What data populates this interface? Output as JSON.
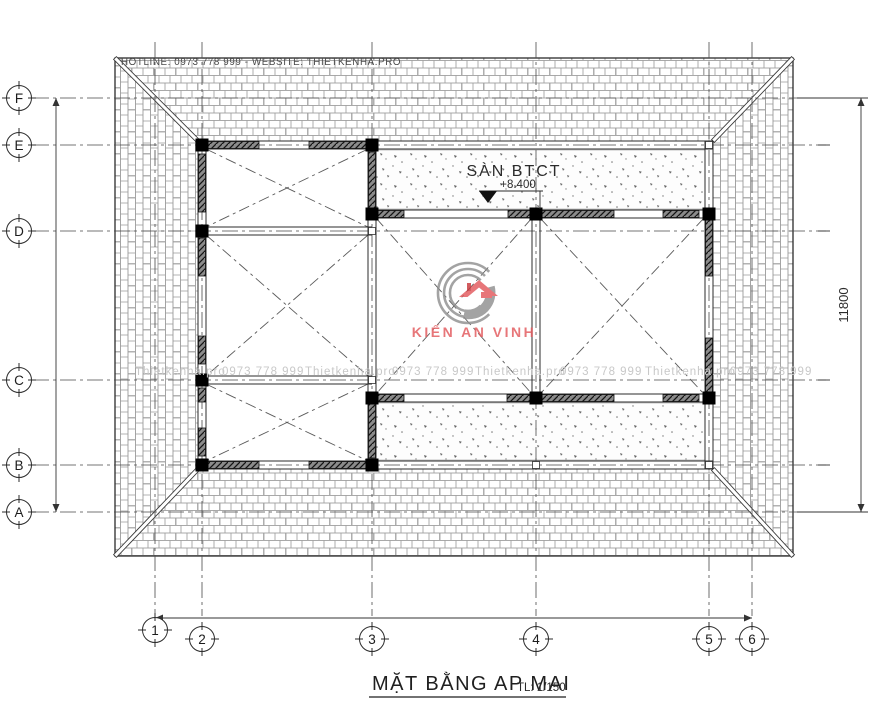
{
  "header": {
    "hotline": "HOTLINE: 0973 778 999 - WEBSITE: THIETKENHA.PRO"
  },
  "plan": {
    "slab_label": "SÀN BTCT",
    "slab_elevation": "+8.400",
    "right_dimension": "11800"
  },
  "grid": {
    "rows": [
      "F",
      "E",
      "D",
      "C",
      "B",
      "A"
    ],
    "cols": [
      "1",
      "2",
      "3",
      "4",
      "5",
      "6"
    ]
  },
  "watermark": {
    "items": [
      "Thietkenha.pro",
      "0973 778 999",
      "Thietkenha.pro",
      "0973 778 999",
      "Thietkenha.pro",
      "0973 778 999",
      "Thietkenha.pro",
      "0973 778 999"
    ]
  },
  "logo": {
    "text": "KIẾN AN VINH"
  },
  "footer": {
    "title": "MẶT BẰNG AP MAI",
    "scale": "TL: 1/150"
  },
  "colors": {
    "line": "#2b2b2b",
    "pattern": "#8d8d8d",
    "watermark": "#c8c8c8",
    "logo_red": "#e2595c",
    "logo_gray": "#8f8f8f"
  }
}
